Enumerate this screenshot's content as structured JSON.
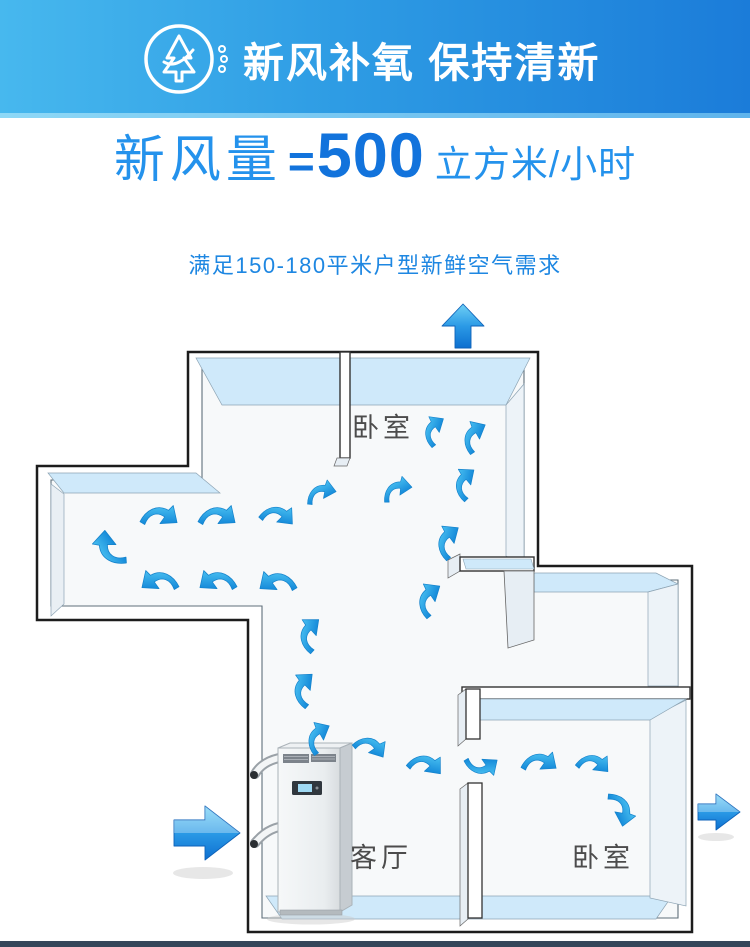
{
  "header": {
    "title": "新风补氧 保持清新",
    "icon": "tree-wind-icon"
  },
  "headline": {
    "prefix": "新风量",
    "equals": "=",
    "value": "500",
    "unit": "立方米/小时"
  },
  "subtitle": {
    "text": "满足150-180平米户型新鲜空气需求"
  },
  "plan": {
    "rooms": [
      {
        "name": "bedroom-top",
        "label": "卧室"
      },
      {
        "name": "living-room",
        "label": "客厅"
      },
      {
        "name": "bedroom-right",
        "label": "卧室"
      }
    ],
    "device": {
      "name": "floor-standing-fresh-air-ventilator"
    },
    "flow_icons": {
      "inlet": "air-inlet-right-arrow",
      "outlet_top": "air-outlet-up-arrow",
      "outlet_right": "air-outlet-right-arrow",
      "circulation": "airflow-curved-arrow"
    }
  },
  "colors": {
    "banner_gradient_start": "#47b8ee",
    "banner_gradient_end": "#1b7cd9",
    "headline_light_blue": "#2492ec",
    "headline_deep_blue": "#1273dc",
    "wall_top_blue": "#cfe9fa",
    "airflow_blue": "#2aa3e8",
    "label_gray": "#4c4c4c",
    "bottom_rule": "#35465a"
  }
}
